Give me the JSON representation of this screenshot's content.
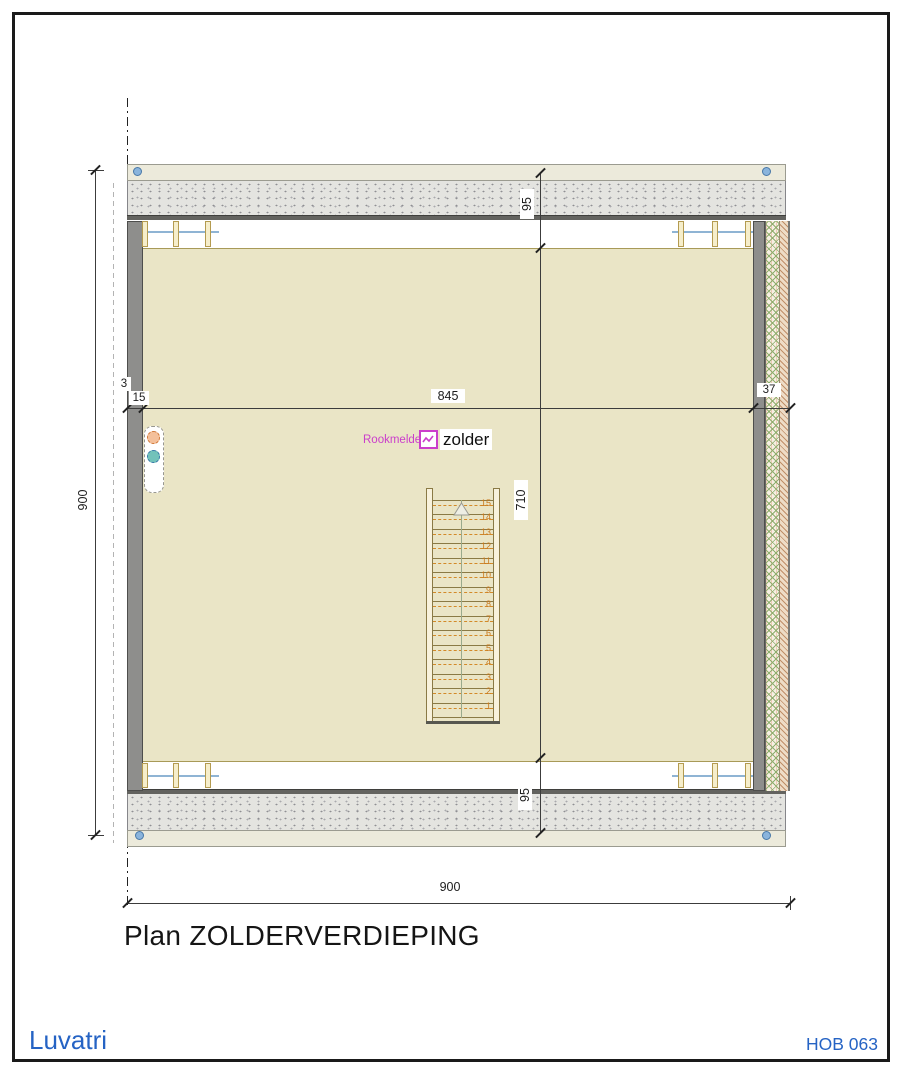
{
  "sheet": {
    "title": "Plan ZOLDERVERDIEPING",
    "brand": "Luvatri",
    "code": "HOB 063"
  },
  "plan": {
    "room_label": "zolder",
    "smoke_detector": {
      "label": "Rookmelder",
      "icon": "smoke-detector-icon"
    },
    "dimensions": {
      "overall_height": "900",
      "overall_width": "900",
      "roof_band_top": "95",
      "interior_depth": "710",
      "roof_band_bottom": "95",
      "axis_offset": "3",
      "left_wall_thickness": "15",
      "interior_width": "845",
      "right_wall_thickness": "37"
    },
    "stair": {
      "steps": [
        "1",
        "2",
        "3",
        "4",
        "5",
        "6",
        "7",
        "8",
        "9",
        "10",
        "11",
        "12",
        "13",
        "14",
        "15"
      ],
      "direction_icon": "up-arrow-icon"
    },
    "icons": {
      "vent_extract": "vent-extract-icon",
      "vent_supply": "vent-supply-icon",
      "connector_dot": "connector-dot-icon"
    },
    "colors": {
      "floor_beige": "#EAE5C6",
      "wall_gray": "#8E8E8C",
      "accent_blue": "#2563C4",
      "magenta": "#CB3ECB",
      "stair_orange": "#C8781C"
    }
  }
}
